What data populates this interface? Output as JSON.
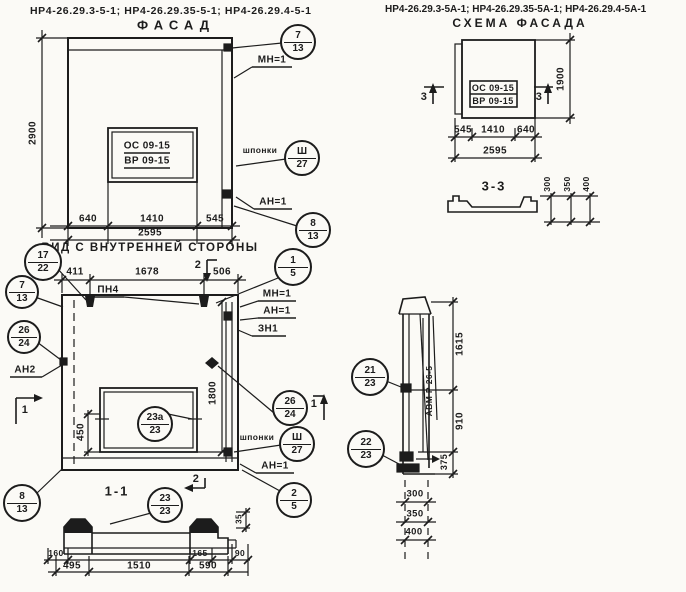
{
  "headers": {
    "left": "НР4-26.29.3-5-1; НР4-26.29.35-5-1; НР4-26.29.4-5-1",
    "right": "НР4-26.29.3-5А-1; НР4-26.29.35-5А-1; НР4-26.29.4-5А-1"
  },
  "titles": {
    "facade": "ФАСАД",
    "scheme": "СХЕМА ФАСАДА",
    "inner": "ВИД С ВНУТРЕННЕЙ СТОРОНЫ",
    "s11": "1-1",
    "s33": "3-3"
  },
  "stamp": {
    "top": "ОС 09-15",
    "bottom": "ВР 09-15"
  },
  "facade": {
    "h": "2900",
    "w1": "640",
    "w2": "1410",
    "w3": "545",
    "total": "2595",
    "mn": "МН=1",
    "shponki": "шпонки",
    "an": "АН=1"
  },
  "scheme": {
    "h": "1900",
    "w1": "545",
    "w2": "1410",
    "w3": "640",
    "total": "2595",
    "m3": "3"
  },
  "s33": {
    "t1": "300",
    "t2": "350",
    "t3": "400"
  },
  "inner": {
    "w1": "411",
    "w2": "1678",
    "w3": "506",
    "pn": "ПН4",
    "d450": "450",
    "d1800": "1800",
    "mn": "МН=1",
    "an1": "АН=1",
    "zn": "ЗН1",
    "an2": "АН2",
    "shponki": "шпонки",
    "an3": "АН=1",
    "m1": "1",
    "m2": "2"
  },
  "s11": {
    "d160": "160",
    "d495": "495",
    "d1510": "1510",
    "d165": "165",
    "d590": "590",
    "d90": "90",
    "d35": "35",
    "m2": "2"
  },
  "side": {
    "avm": "АВМ Р 26-5",
    "d1": "1615",
    "d2": "910",
    "d3": "375",
    "t1": "300",
    "t2": "350",
    "t3": "400"
  },
  "callouts": {
    "c7": {
      "top": "7",
      "bot": "13"
    },
    "c8": {
      "top": "8",
      "bot": "13"
    },
    "csh": {
      "top": "Ш",
      "bot": "27"
    },
    "c17": {
      "top": "17",
      "bot": "22"
    },
    "c26": {
      "top": "26",
      "bot": "24"
    },
    "c1": {
      "top": "1",
      "bot": "5"
    },
    "c2": {
      "top": "2",
      "bot": "5"
    },
    "c23a": {
      "top": "23а",
      "bot": "23"
    },
    "c23": {
      "top": "23",
      "bot": "23"
    },
    "c21": {
      "top": "21",
      "bot": "23"
    },
    "c22": {
      "top": "22",
      "bot": "23"
    }
  }
}
